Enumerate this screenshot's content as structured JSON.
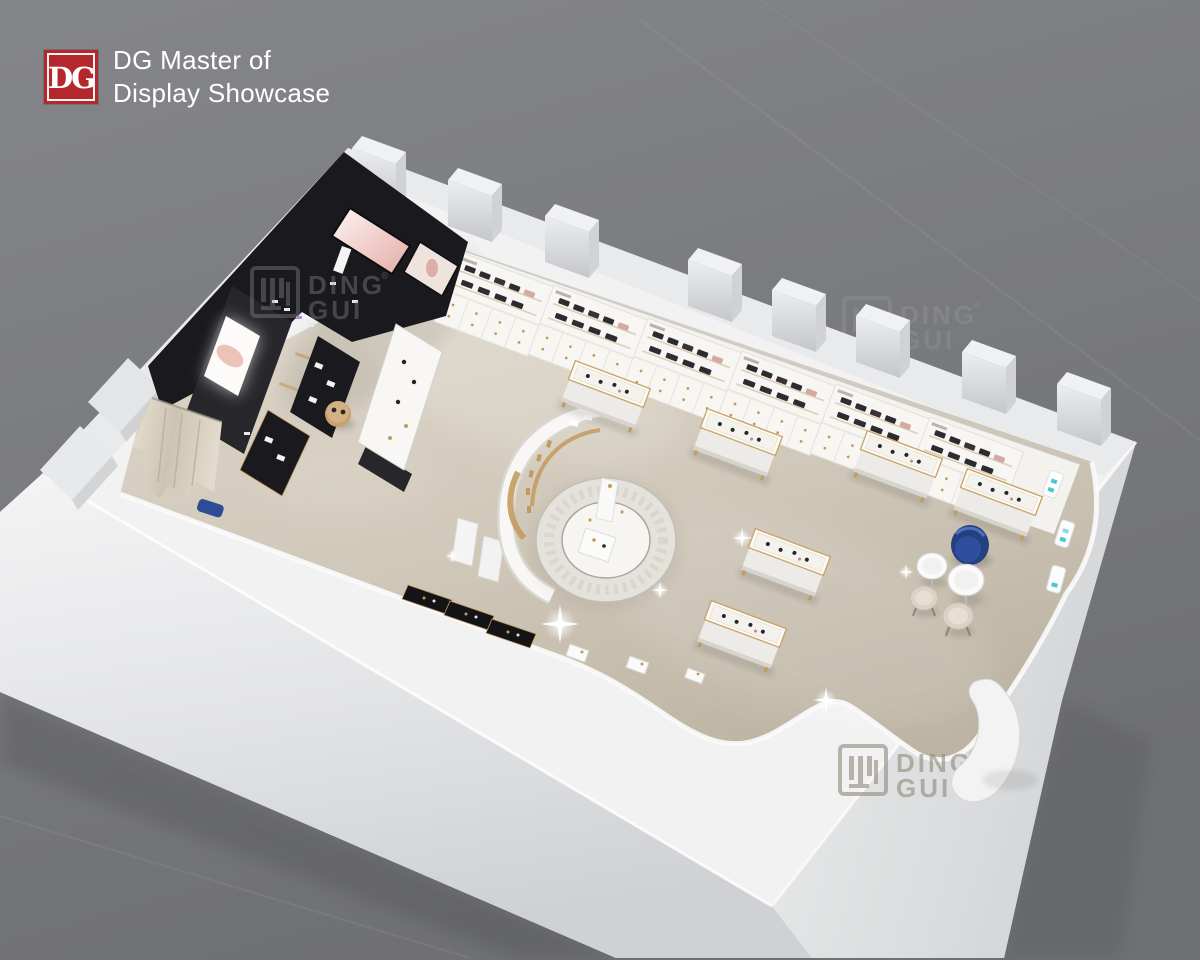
{
  "logo": {
    "mark": "DG",
    "line1": "DG Master of",
    "line2": "Display Showcase"
  },
  "watermark": {
    "mark": "DG",
    "line1": "DING",
    "line2": "GUI",
    "reg": "®"
  },
  "colors": {
    "red": "#b4282d",
    "bg1": "#85868a",
    "bg2": "#6f7074",
    "wall": "#f2f2f3",
    "wallTop": "#e9eaec",
    "wallShade": "#c7c9cb",
    "floorLight": "#ded7ca",
    "floorMid": "#cfc7b8",
    "floorDark": "#bcb3a2",
    "black": "#1a1a1e",
    "blackSoft": "#27272b",
    "gold": "#c39a5e",
    "wood": "#c6a171",
    "blue": "#2f4f9e",
    "teal": "#4cc6d5",
    "cream": "#f6f5f2"
  }
}
